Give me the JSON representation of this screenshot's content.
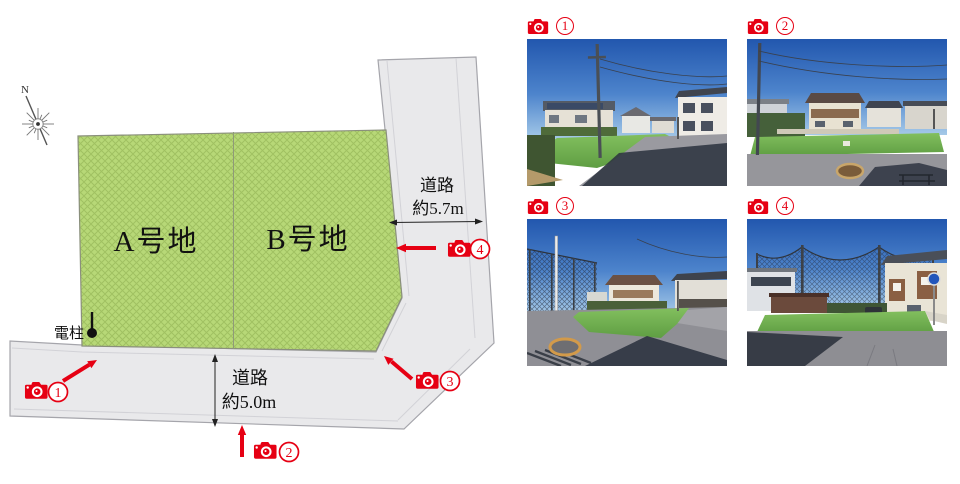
{
  "site_plan": {
    "compass": {
      "north_label": "N"
    },
    "plots": [
      {
        "label": "A号地"
      },
      {
        "label": "B号地"
      }
    ],
    "roads": {
      "east": {
        "name": "道路",
        "width": "約5.7m"
      },
      "south": {
        "name": "道路",
        "width": "約5.0m"
      }
    },
    "utility_pole": {
      "label": "電柱"
    },
    "camera_markers": [
      {
        "number": "1"
      },
      {
        "number": "2"
      },
      {
        "number": "3"
      },
      {
        "number": "4"
      }
    ]
  },
  "photo_panel": {
    "items": [
      {
        "number": "1"
      },
      {
        "number": "2"
      },
      {
        "number": "3"
      },
      {
        "number": "4"
      }
    ]
  },
  "colors": {
    "accent_red": "#e60013",
    "plot_green": "#b7d877",
    "road_gray": "#e9e9eb"
  }
}
